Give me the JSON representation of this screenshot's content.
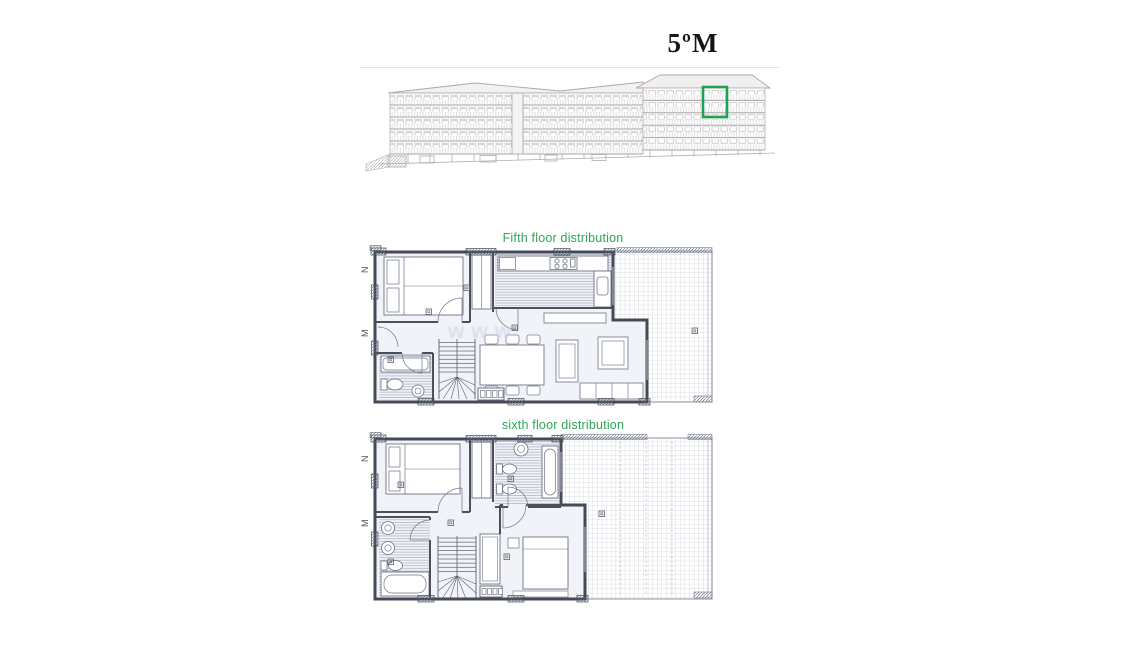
{
  "page": {
    "title": "5ºM"
  },
  "floor_plans": [
    {
      "id": "fifth",
      "label": "Fifth floor distribution",
      "unit_markers": [
        "N",
        "M"
      ]
    },
    {
      "id": "sixth",
      "label": "sixth floor distribution",
      "unit_markers": [
        "N",
        "M"
      ]
    }
  ],
  "watermark": "www",
  "colors": {
    "label_green": "#2fa457",
    "highlight_green": "#1ba351",
    "plan_wall": "#474c58",
    "plan_floor_fill": "#f1f3f8",
    "elevation_line": "#b7b0b2",
    "terrace_grid": "#b3b9c7"
  }
}
